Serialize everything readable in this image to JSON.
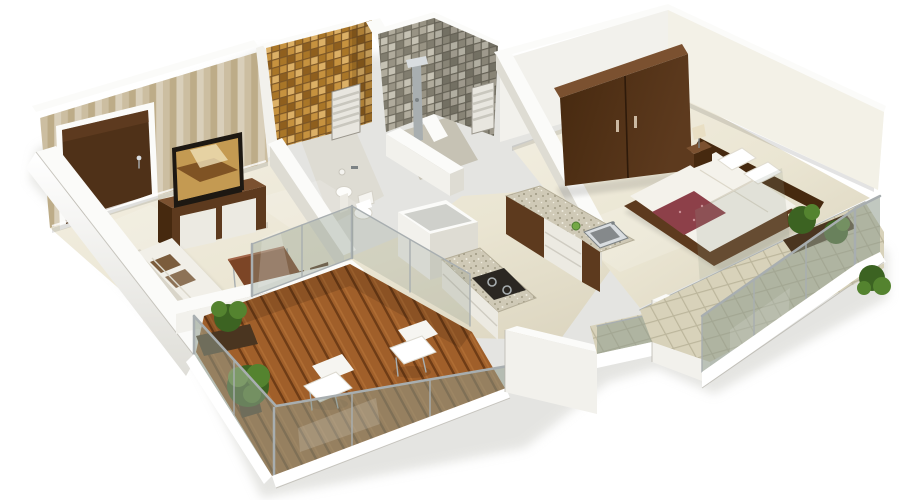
{
  "meta": {
    "title": "3D isometric cutaway floor plan of a 1BHK apartment",
    "view": "dollhouse aerial render, no visible text in image"
  },
  "palette": {
    "bg": "#ffffff",
    "shadow": "#cbcbc5",
    "floor_light": "#f3efe2",
    "floor_cream": "#eae5d2",
    "floor_dark": "#d9d2bc",
    "wall_white": "#f2f1ec",
    "wall_shade": "#dedcd3",
    "wall_cap": "#fbfbf9",
    "wall_edge": "#b4b1a8",
    "wallpaper_a": "#d8cbae",
    "wallpaper_b": "#c8b893",
    "wallpaper_c": "#e7dec9",
    "door_wood": "#4f3118",
    "door_wood_light": "#6b4426",
    "wood_dark": "#46290f",
    "wood_mid": "#5d3a1e",
    "wood_top": "#7b5130",
    "tv_frame": "#1d1812",
    "tv_gold": "#c49a52",
    "tv_gold_dark": "#6e4119",
    "gold_a": "#c6923f",
    "gold_b": "#a97628",
    "gold_c": "#dcb066",
    "gold_d": "#8f5f1e",
    "gold_grout": "#7a5526",
    "grey_a": "#b0ab9c",
    "grey_b": "#989384",
    "grey_c": "#c6c2b4",
    "grey_d": "#817d6f",
    "grey_grout": "#6f6b5e",
    "granite": "#cfc9b6",
    "granite_dot1": "#a49d87",
    "granite_dot2": "#8d8670",
    "granite_hi": "#efece0",
    "steel": "#a8aeb0",
    "steel_light": "#d9dde0",
    "steel_dark": "#7c8284",
    "glass_tint": "#8e9a8c",
    "deck_plank": "#a05f2a",
    "deck_gap": "#6e3c16",
    "deck_hi": "#b9763b",
    "sofa_white": "#f1efe8",
    "sofa_shade": "#d9d5c9",
    "cushion_brown": "#7b5c3c",
    "table_wood": "#7c4526",
    "bed_white": "#f4f2eb",
    "bed_fold": "#dcd7c9",
    "runner_maroon": "#8d4049",
    "lamp_cream": "#e9dfc4",
    "plant_dark": "#3c6322",
    "plant_mid": "#54832f",
    "plant_light": "#74a845",
    "planter_brown": "#4a3520",
    "tile_balcony": "#d8d2ba",
    "tile_grout": "#bcb69c",
    "cabinet_white": "#eceae2",
    "hob_black": "#2b2722"
  },
  "rooms": [
    {
      "name": "living-room",
      "wall_finish": "striped beige wallpaper",
      "floor": "cream gloss tile",
      "items": [
        "entrance-door",
        "tv-unit",
        "flat-screen-tv",
        "sofa-with-cushions",
        "coffee-table",
        "dining-chairs",
        "sliding-glass-door"
      ]
    },
    {
      "name": "toilet-bathroom",
      "wall_finish": "gold mosaic tile",
      "items": [
        "wash-basin",
        "wc-toilet",
        "louvered-window",
        "paper-holder"
      ]
    },
    {
      "name": "shower-bathroom",
      "wall_finish": "grey mosaic tile",
      "items": [
        "shower-panel",
        "louvered-window"
      ]
    },
    {
      "name": "kitchen",
      "items": [
        "granite-counter-with-sink",
        "granite-counter-with-hob",
        "wood-and-white-cabinets",
        "appliance-platform",
        "vegetable"
      ]
    },
    {
      "name": "bedroom",
      "wall_finish": "cream paint",
      "items": [
        "wardrobe",
        "double-bed",
        "headboard",
        "maroon-bed-runner",
        "pillows",
        "bedside-table",
        "table-lamp",
        "sliding-glass-pane"
      ]
    },
    {
      "name": "front-balcony",
      "floor": "wood plank deck",
      "items": [
        "glass-railing",
        "lounge-chair",
        "lounge-chair",
        "shrub-planter",
        "shrub"
      ]
    },
    {
      "name": "bedroom-balcony",
      "floor": "beige tiles",
      "items": [
        "glass-railing",
        "potted-plants",
        "corner-shrub"
      ]
    }
  ]
}
